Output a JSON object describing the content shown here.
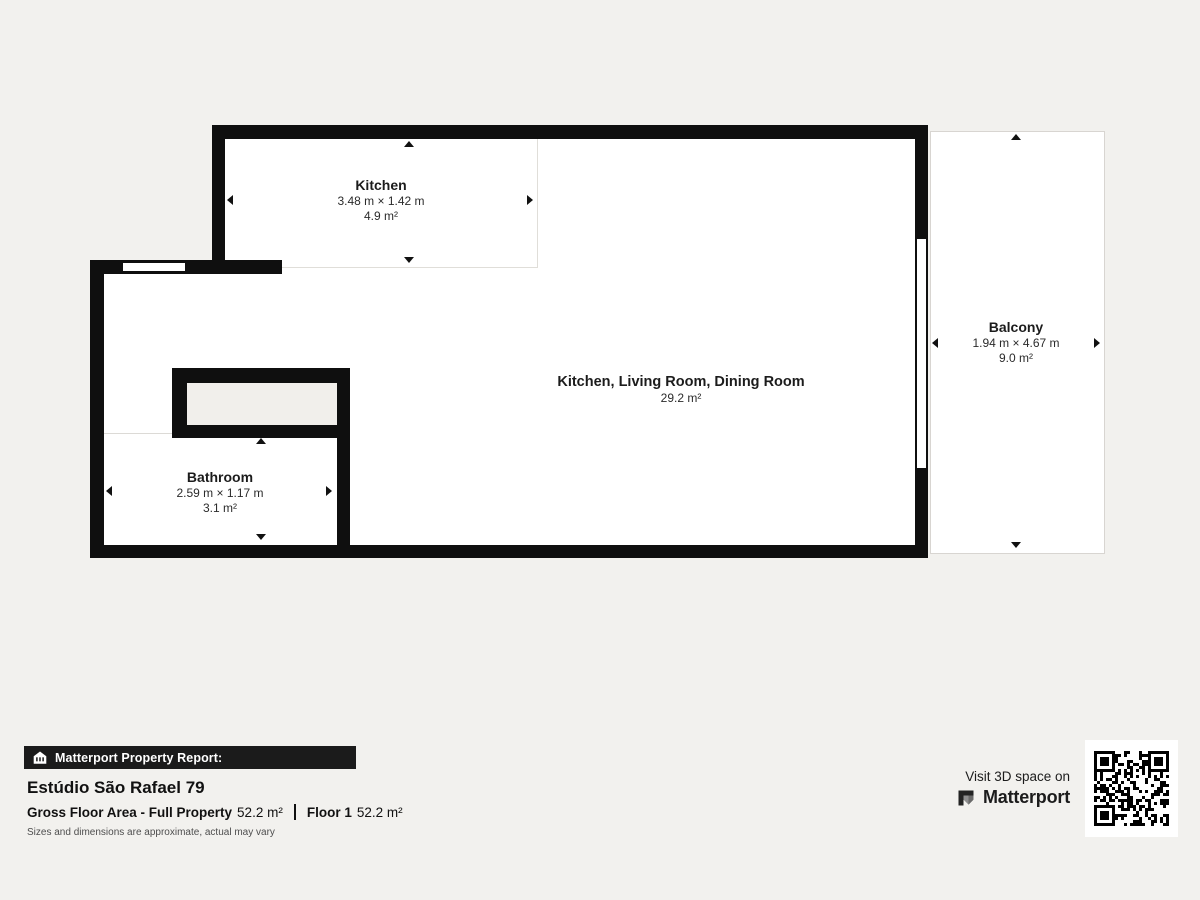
{
  "colors": {
    "background": "#f2f1ee",
    "wall": "#0f0f0f",
    "floor": "#ffffff",
    "banner_bg": "#1b1b1b"
  },
  "rooms": {
    "kitchen": {
      "name": "Kitchen",
      "dims": "3.48 m × 1.42 m",
      "area": "4.9 m²"
    },
    "main": {
      "name": "Kitchen, Living Room, Dining Room",
      "area": "29.2 m²"
    },
    "bathroom": {
      "name": "Bathroom",
      "dims": "2.59 m × 1.17 m",
      "area": "3.1 m²"
    },
    "balcony": {
      "name": "Balcony",
      "dims": "1.94 m × 4.67 m",
      "area": "9.0 m²"
    }
  },
  "report": {
    "banner": "Matterport Property Report:",
    "property_name": "Estúdio São Rafael 79",
    "stats": {
      "gross_label": "Gross Floor Area - Full Property",
      "gross_value": "52.2 m²",
      "floor_label": "Floor 1",
      "floor_value": "52.2 m²"
    },
    "disclaimer": "Sizes and dimensions are approximate, actual may vary"
  },
  "cta": {
    "line1": "Visit 3D space on",
    "brand": "Matterport"
  },
  "icons": {
    "banner_icon": "house-icon",
    "brand_icon": "matterport-logo-icon",
    "qr": "qr-code-icon"
  }
}
